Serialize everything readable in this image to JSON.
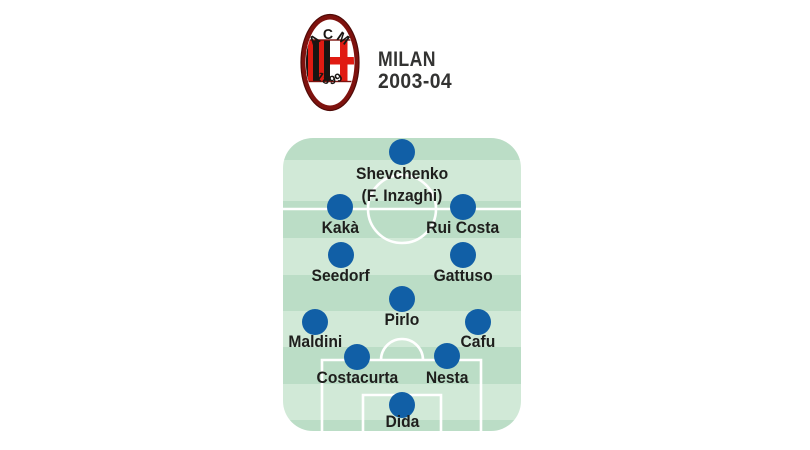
{
  "header": {
    "club": "MILAN",
    "season": "2003-04",
    "crest": {
      "acronym": "ACM",
      "founded": "1899"
    }
  },
  "colors": {
    "header_text": "#333332",
    "pitch_light": "#d1e9d7",
    "pitch_dark": "#bbddc6",
    "pitch_line": "#ffffff",
    "player_dot": "#115fa6",
    "label_text": "#1e1e1c",
    "crest_maroon": "#7e120e",
    "crest_red": "#e01b12",
    "crest_black": "#191512"
  },
  "formation": {
    "players": [
      {
        "name": "Shevchenko",
        "sub": "(F. Inzaghi)",
        "x": 402,
        "y": 152,
        "label_y": 174,
        "sub_y": 196
      },
      {
        "name": "Kakà",
        "x": 340,
        "y": 207,
        "label_y": 228
      },
      {
        "name": "Rui Costa",
        "x": 463,
        "y": 207,
        "label_y": 228
      },
      {
        "name": "Seedorf",
        "x": 341,
        "y": 255,
        "label_y": 276
      },
      {
        "name": "Gattuso",
        "x": 463,
        "y": 255,
        "label_y": 276
      },
      {
        "name": "Pirlo",
        "x": 402,
        "y": 299,
        "label_y": 320
      },
      {
        "name": "Maldini",
        "x": 315,
        "y": 322,
        "label_y": 342
      },
      {
        "name": "Cafu",
        "x": 478,
        "y": 322,
        "label_y": 342
      },
      {
        "name": "Costacurta",
        "x": 357,
        "y": 357,
        "label_y": 378
      },
      {
        "name": "Nesta",
        "x": 447,
        "y": 356,
        "label_y": 378
      },
      {
        "name": "Dida",
        "x": 402,
        "y": 405,
        "label_y": 422
      }
    ]
  }
}
